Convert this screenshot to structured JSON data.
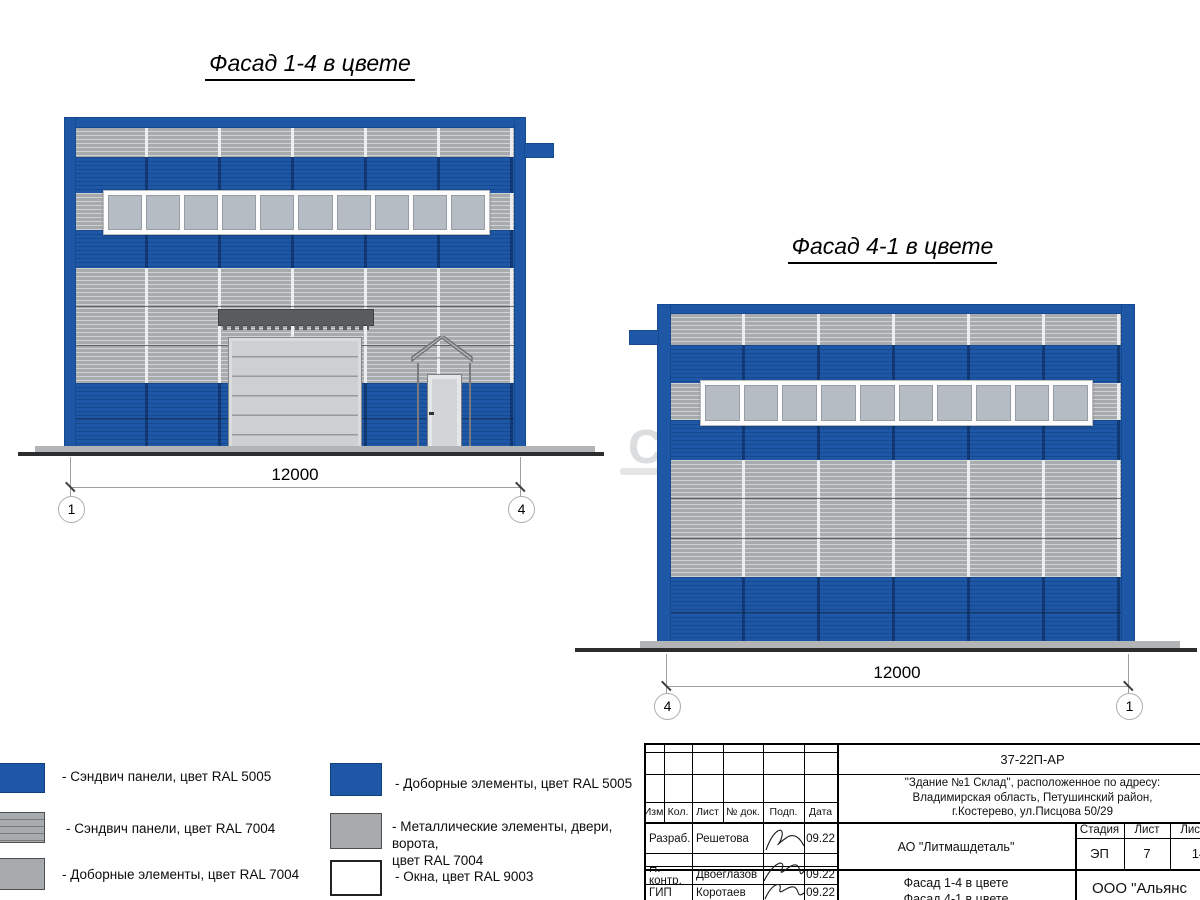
{
  "colors": {
    "blue": "#1e57a6",
    "blue_dark": "#164a90",
    "gray": "#a8abae",
    "glass": "#b6bcc4",
    "door": "#cdcfd1",
    "canopy": "#595b5e",
    "ground": "#2c2d2e"
  },
  "facade_14": {
    "title": "Фасад 1-4 в цвете",
    "dimension": "12000",
    "axis_left": "1",
    "axis_right": "4",
    "window_count": 10
  },
  "facade_41": {
    "title": "Фасад 4-1 в цвете",
    "dimension": "12000",
    "axis_left": "4",
    "axis_right": "1",
    "window_count": 10
  },
  "legend": {
    "left": [
      {
        "ral": "RAL 5005",
        "label": "- Сэндвич панели, цвет RAL 5005"
      },
      {
        "ral": "RAL 7004",
        "label": "- Сэндвич панели, цвет RAL 7004"
      },
      {
        "ral": "RAL 7004",
        "label": "- Доборные элементы, цвет RAL 7004"
      }
    ],
    "right": [
      {
        "ral": "RAL 5005",
        "label": "- Доборные элементы, цвет RAL 5005"
      },
      {
        "ral": "RAL 7004",
        "label": "- Металлические элементы, двери, ворота,\nцвет RAL 7004"
      },
      {
        "ral": "RAL 9003",
        "label": "- Окна, цвет RAL 9003"
      }
    ]
  },
  "titleblock": {
    "doc_number": "37-22П-АР",
    "object_address": "\"Здание №1 Склад\", расположенное по адресу:\nВладимирская область, Петушинский район,\nг.Костерево, ул.Писцова 50/29",
    "col_izm": "Изм.",
    "col_kol": "Кол.",
    "col_list": "Лист",
    "col_doc": "№ док.",
    "col_podp": "Подп.",
    "col_data": "Дата",
    "row1_role": "Разраб.",
    "row1_name": "Решетова",
    "row1_date": "09.22",
    "row2_role": "Н. контр.",
    "row2_name": "Двоеглазов",
    "row2_date": "09.22",
    "row3_role": "ГИП",
    "row3_name": "Коротаев",
    "row3_date": "09.22",
    "client": "АО \"Литмашдеталь\"",
    "stage_label": "Стадия",
    "stage": "ЭП",
    "sheet_label": "Лист",
    "sheet": "7",
    "sheets_label": "Листов",
    "sheets": "14",
    "sheet_title": "Фасад 1-4 в цвете\nФасад 4-1 в цвете",
    "company": "ООО \"Альянс"
  },
  "watermark": "С"
}
